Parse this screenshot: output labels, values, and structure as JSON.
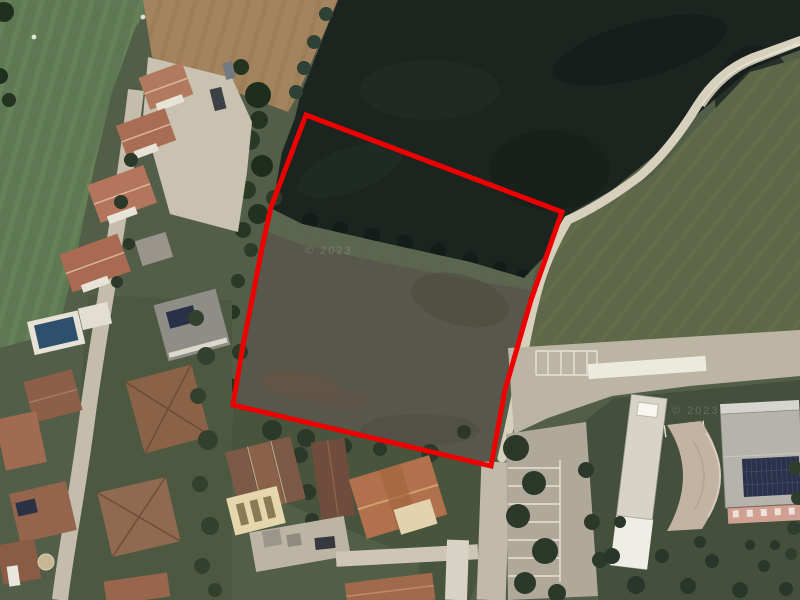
{
  "app": {
    "name": "aerial-parcel-view",
    "description": "satellite photo of a land parcel outlined in red between a residential street and a public building with parking"
  },
  "annotation": {
    "name": "parcel-boundary",
    "shape": "polygon",
    "color": "#ee0000",
    "stroke_width": "5",
    "points": "306,115 562,212 531,300 505,390 491,466 233,405 243,345 252,300 262,248 271,207"
  },
  "watermarks": [
    {
      "text": "© 2023"
    },
    {
      "text": "© 2023"
    }
  ],
  "palette": {
    "annotation_red": "#ee0000",
    "dark_field": "#1c2420",
    "green_field": "#5d7852",
    "olive_field": "#5e6848",
    "plowed_field": "#a3845e",
    "parcel_interior": "#57574b",
    "dirt_path": "#d7d0bc",
    "street": "#c5bdab",
    "roof_terracotta": "#ad7058",
    "tree_green": "#2c382a",
    "pool_blue": "#2f506c",
    "solar_panel": "#2a3148"
  }
}
